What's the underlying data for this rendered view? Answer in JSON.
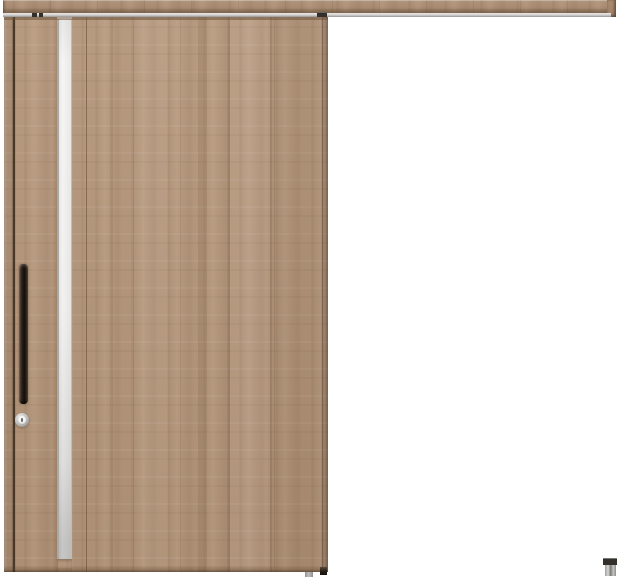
{
  "scene": {
    "description": "Product photograph of a single outset sliding interior door in a light greige wood-grain finish, hung from a long wood-fascia top rail extending to the right, with a full-height frosted glass slit near the leading stile, a black vertical bar handle, a round silver thumbturn lock, and a small metal floor guide at the lower right."
  },
  "colors": {
    "background": "#ffffff",
    "wood-base": "#b29478",
    "wood-rail": "#ab8c72",
    "wood-edge": "#9d8067",
    "wood-dark-line": "#4a3826",
    "glass": "#f2f1ef",
    "glass-frame": "#a9a9a7",
    "track": "#d7d6d4",
    "handle": "#1f1813",
    "thumbturn-ring": "#b9b9b7",
    "thumbturn-face": "#f4f4f2",
    "hardware-dark": "#33302c",
    "guide-metal": "#c0c0be"
  },
  "parts": {
    "rail": "hanger rail with wood fascia and aluminum track",
    "door": "sliding door panel, wood grain finish",
    "glass": "vertical frosted glass slit",
    "handle": "vertical bar pull handle, dark bronze",
    "lock": "round thumbturn lock",
    "floor_guide": "lower floor guide fitting"
  }
}
